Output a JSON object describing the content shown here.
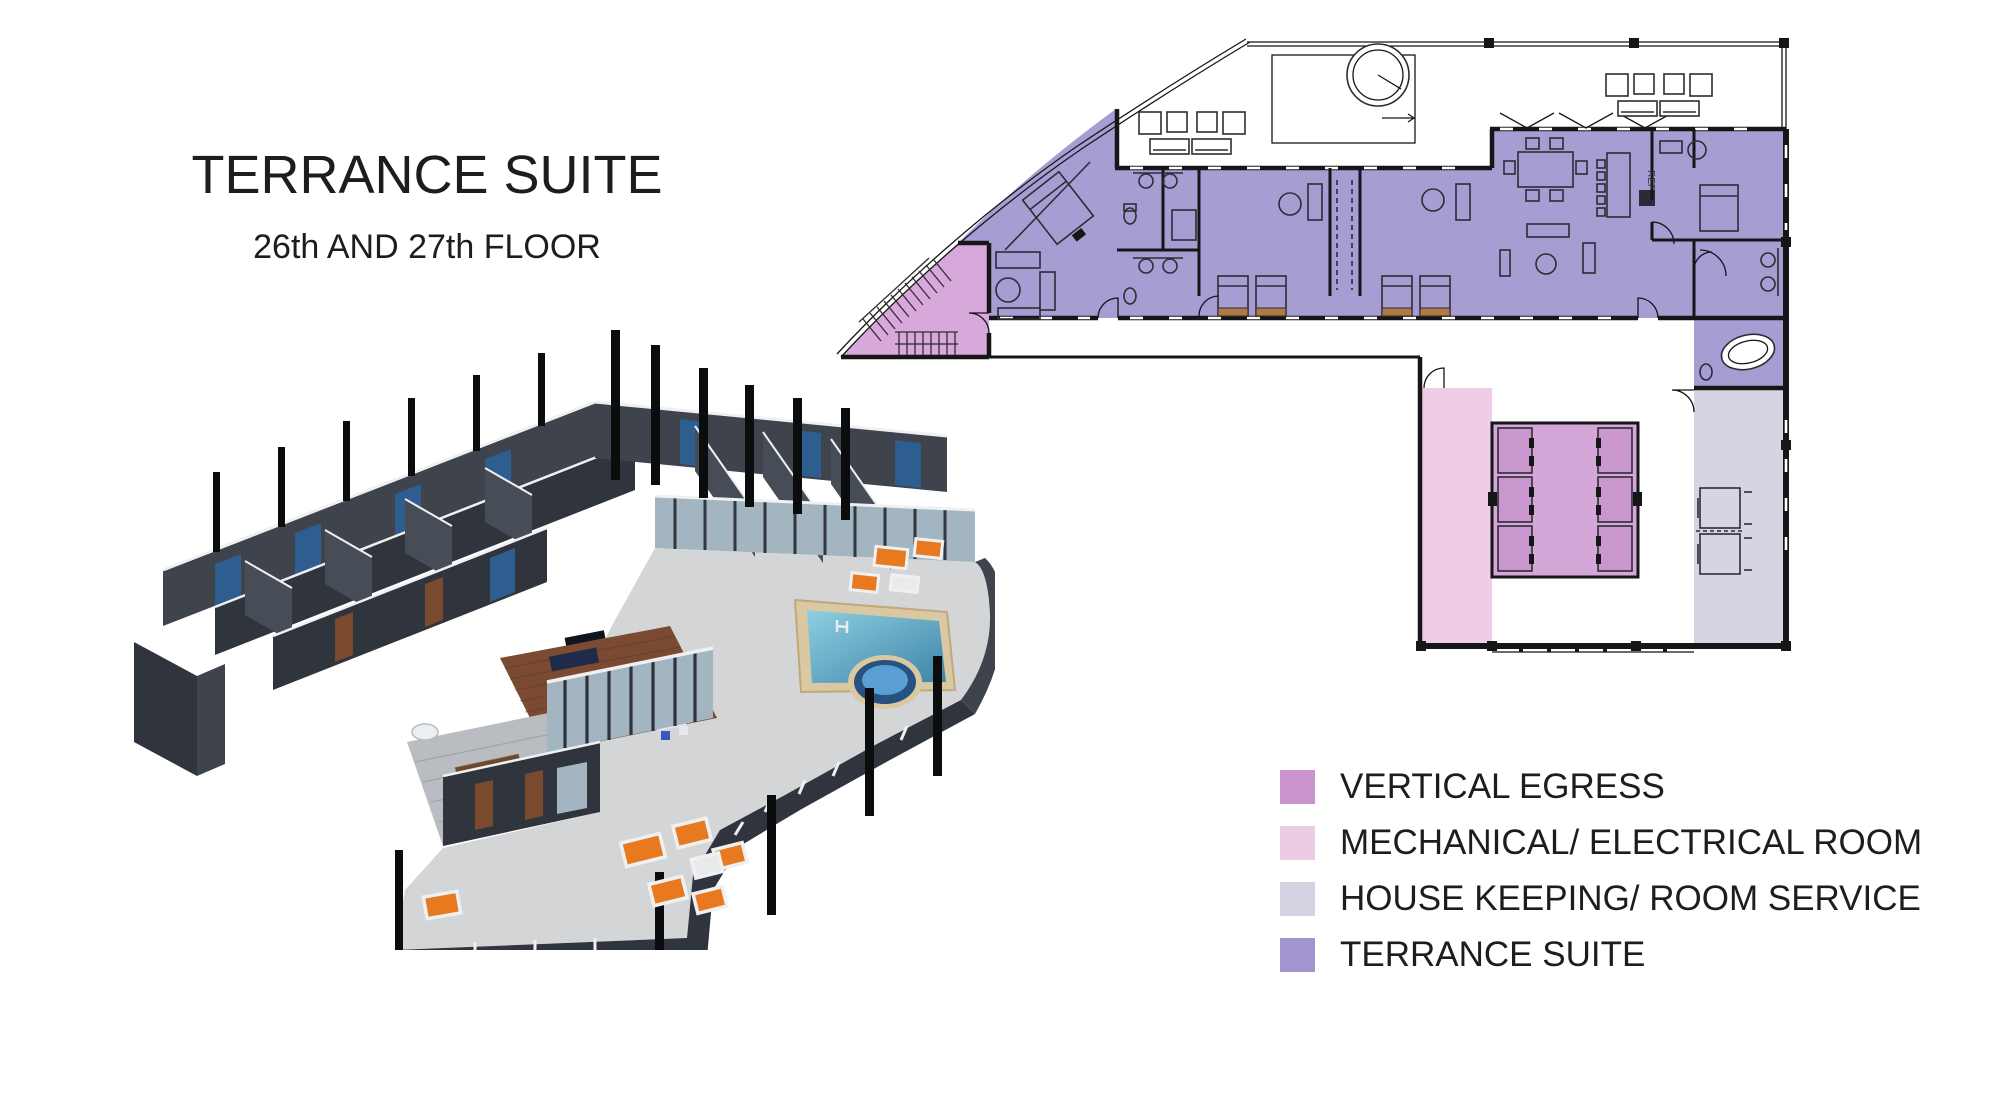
{
  "title": {
    "main": "TERRANCE SUITE",
    "subtitle": "26th AND 27th FLOOR"
  },
  "legend": {
    "items": [
      {
        "label": "VERTICAL EGRESS",
        "color": "#c994cd"
      },
      {
        "label": "MECHANICAL/ ELECTRICAL ROOM",
        "color": "#eccbe4"
      },
      {
        "label": "HOUSE KEEPING/ ROOM SERVICE",
        "color": "#d3d3e2"
      },
      {
        "label": "TERRANCE SUITE",
        "color": "#a295ce"
      }
    ]
  },
  "plan": {
    "labels": {
      "ref": "REF"
    }
  },
  "colors": {
    "ink": "#161619",
    "suite": "#a79dd3",
    "egressStair": "#d9a8da",
    "egressLobby": "#d5a7d8",
    "egressShaft": "#c996cd",
    "mech": "#efcde7",
    "housekeeping": "#d4d4e2",
    "wall": "#3e434c",
    "wallDark": "#30343c",
    "wallMid": "#474d57",
    "floor": "#c9cacd",
    "terrace": "#d4d5d7",
    "wood": "#7b4a33",
    "woodLine": "#5e3520",
    "plankGray": "#b9bcc1",
    "deck": "#d9c8a2",
    "poolLight": "#8ed0e2",
    "poolDeep": "#3d84a8",
    "spaRing": "#27517e",
    "spaWater": "#5a9fd4",
    "orange": "#e8791e",
    "navy": "#1e2c49",
    "panelBlue": "#2e5d8f",
    "glass": "#a3b5c0",
    "columnBlack": "#0b0c0e",
    "bedTan": "#d6c096",
    "rug": "#5549a8",
    "topEdge": "#eff0f2"
  }
}
